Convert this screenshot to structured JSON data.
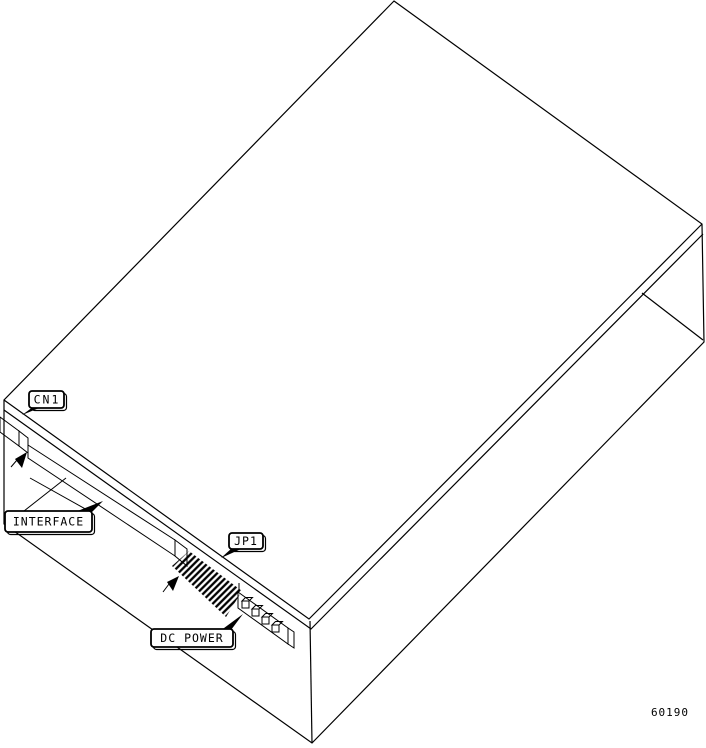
{
  "figure_number": "60190",
  "callouts": {
    "cn1": "CN1",
    "interface": "INTERFACE",
    "jp1": "JP1",
    "dc_power": "DC POWER"
  },
  "colors": {
    "ink": "#000000",
    "paper": "#ffffff"
  }
}
